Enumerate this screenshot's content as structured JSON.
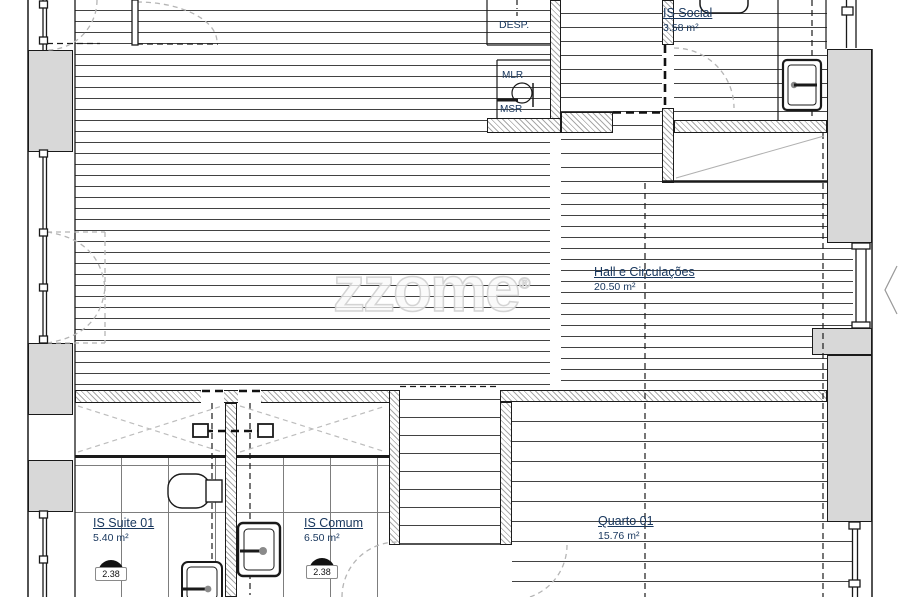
{
  "watermark": {
    "text": "zzome",
    "mark": "®"
  },
  "labels": {
    "desp": "DESP.",
    "mlr": "MLR",
    "msr": "MSR"
  },
  "rooms": {
    "is_social": {
      "name": "IS Social",
      "area": "3.58 m²"
    },
    "hall": {
      "name": "Hall e Circulações",
      "area": "20.50 m²"
    },
    "is_suite": {
      "name": "IS Suite 01",
      "area": "5.40 m²",
      "ceiling_height": "2.38"
    },
    "is_comum": {
      "name": "IS Comum",
      "area": "6.50 m²",
      "ceiling_height": "2.38"
    },
    "quarto": {
      "name": "Quarto 01",
      "area": "15.76 m²"
    }
  },
  "colors": {
    "label": "#17365d",
    "wall_gray": "#d8d8d8",
    "line": "#1a1a1a"
  }
}
